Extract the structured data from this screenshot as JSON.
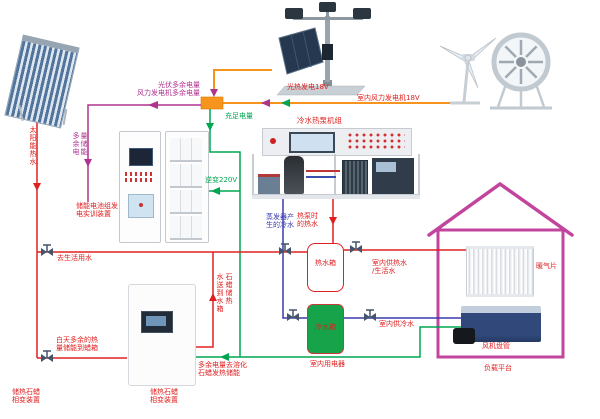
{
  "diagram": {
    "labels": {
      "pv_excess": {
        "line1": "光伏多余电量",
        "line2": "风力发电机多余电量"
      },
      "pv_generation": "光热发电18V",
      "wind_generation": "室内风力发电机18V",
      "sufficient_power": "充足电量",
      "excess_storage": "多余电量储能",
      "inverter": "逆变220V",
      "battery_device": {
        "line1": "储能电池组发",
        "line2": "电实训装置"
      },
      "heat_pump_title": "冷水热泵机组",
      "solar_hot_water": "太阳能热水",
      "to_domestic_water": "去生活用水",
      "evaporator_cold": {
        "line1": "蒸发器产",
        "line2": "生的冷水"
      },
      "heat_pump_hot": {
        "line1": "热泵时",
        "line2": "的热水"
      },
      "hot_tank": "热水箱",
      "cold_tank": "冷水箱",
      "indoor_hot_water": {
        "line1": "室内供热水",
        "line2": "/生活水"
      },
      "indoor_cold_water": "室内供冷水",
      "day_excess_heat": {
        "line1": "白天多余的热",
        "line2": "量储能到蜡箱"
      },
      "paraffin_send_col_left": "水送到水箱",
      "paraffin_send_col_right": "石蜡储热",
      "melt_paraffin": {
        "line1": "多余电量去溶化",
        "line2": "石蜡发热储能"
      },
      "indoor_appliances": "室内用电器",
      "paraffin_device": {
        "line1": "储热石蜡",
        "line2": "相变装置"
      },
      "paraffin_device_corner": {
        "line1": "储热石蜡",
        "line2": "相变装置"
      },
      "radiator": "暖气片",
      "fan_coil": "风机盘管",
      "load_platform": "负载平台"
    },
    "colors": {
      "power_bus_orange": "#F7941D",
      "grid_green": "#00A550",
      "excess_magenta": "#B03390",
      "hot_water_red": "#E02020",
      "cold_water_blue": "#3A3AAE",
      "house_outline": "#C2449C"
    }
  }
}
